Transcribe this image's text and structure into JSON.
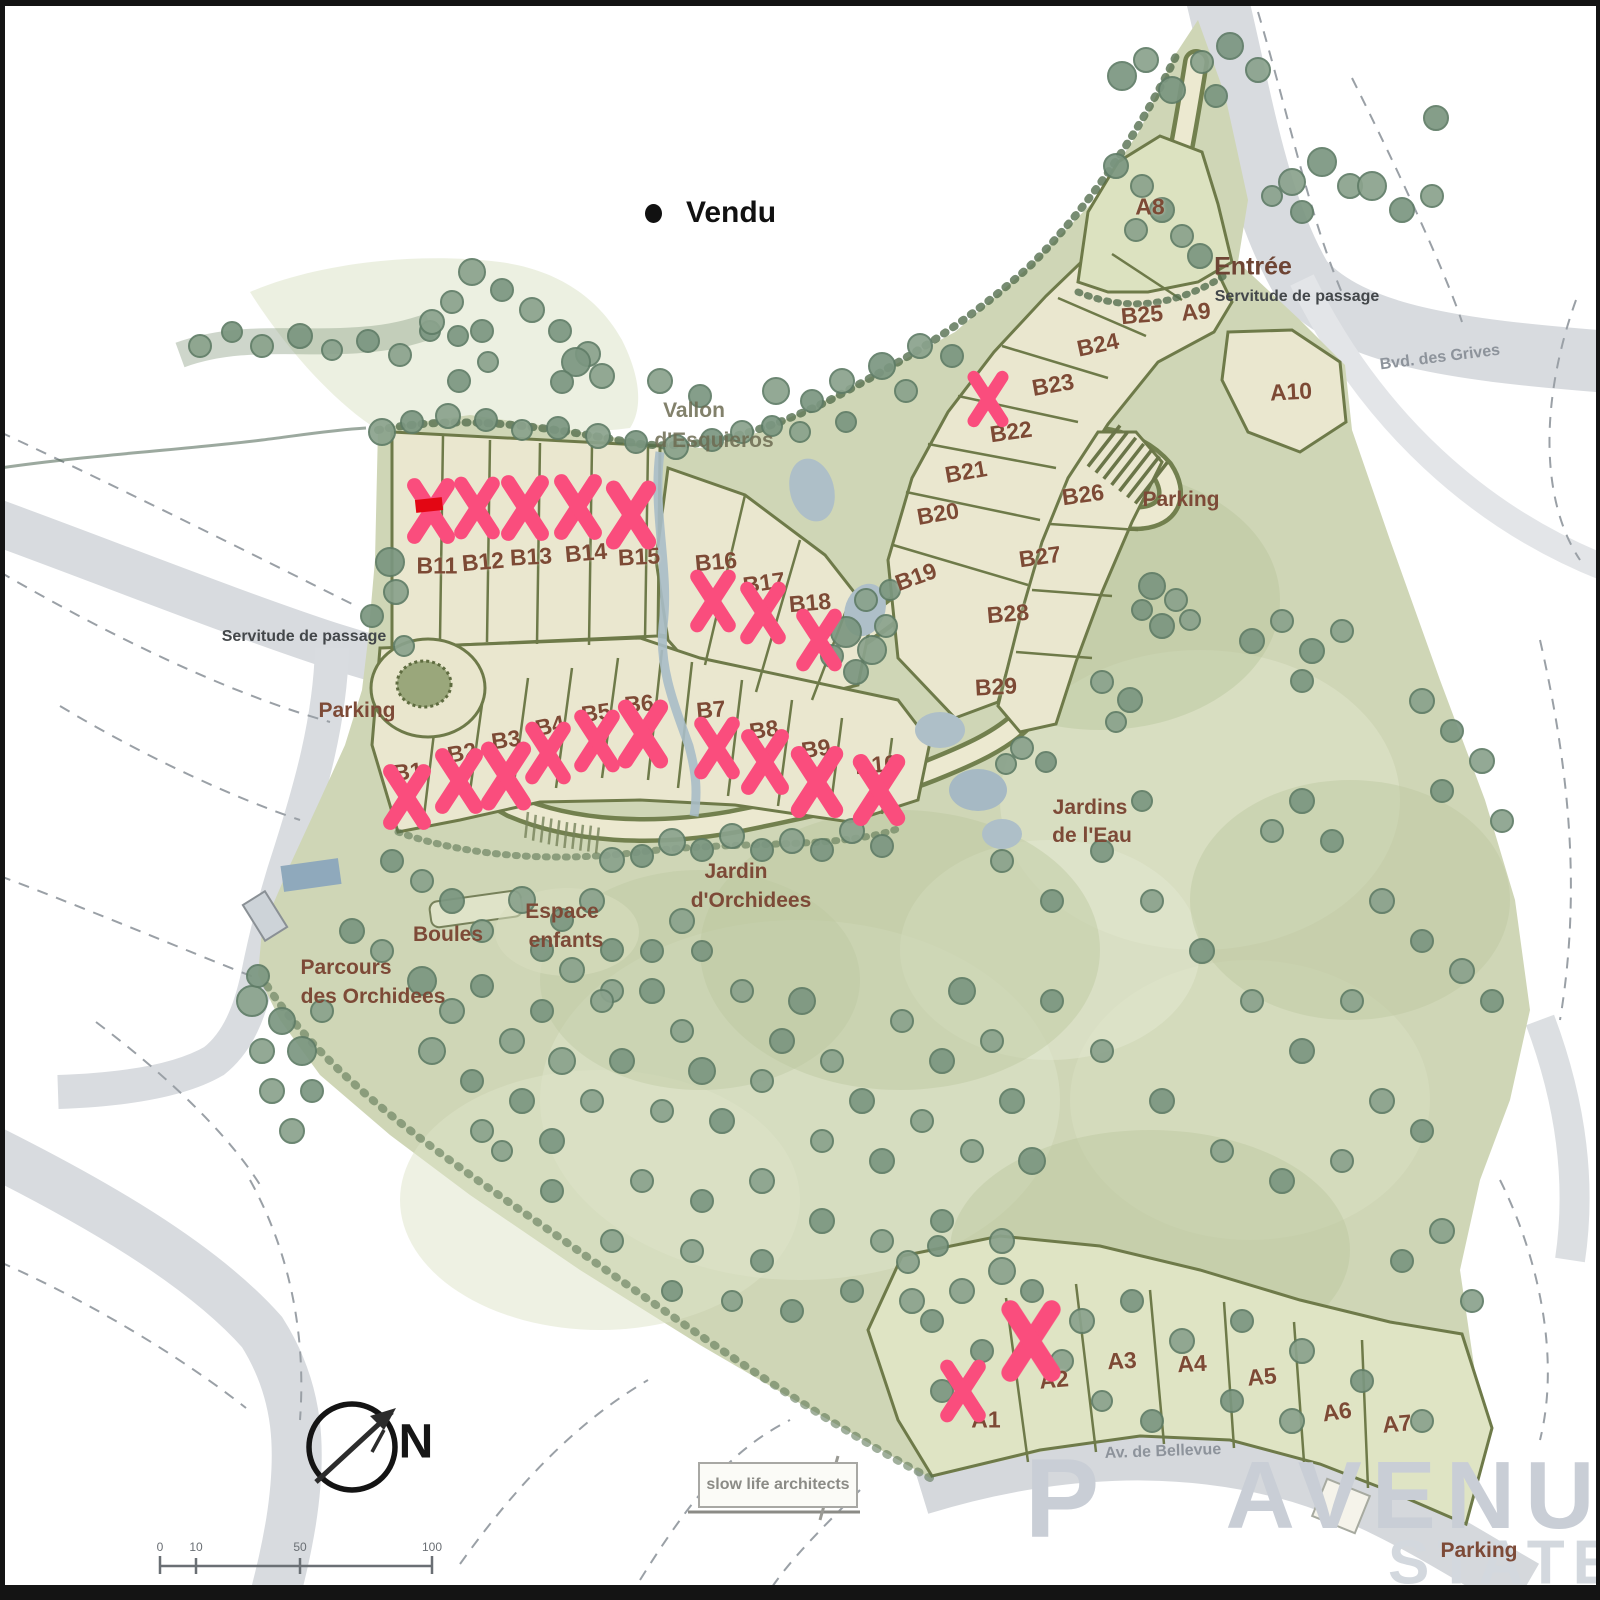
{
  "legend": {
    "label": "Vendu"
  },
  "compass": {
    "label": "N"
  },
  "attribution": {
    "label": "slow life architects"
  },
  "watermark": {
    "fragment": "P",
    "line1": "AVENUE",
    "line2": "STATE"
  },
  "scalebar": {
    "ticks": [
      "0",
      "10",
      "50",
      "100"
    ]
  },
  "colors": {
    "sold_mark": "#fa4d7d",
    "lot_label_brown": "#7d4a35",
    "site_green": "#cfd6b6",
    "lot_fill": "#eae7cf",
    "road_gray": "#d8dbdf",
    "tree_green": "#84a087",
    "red_rect": "#e30613"
  },
  "lots": [
    {
      "id": "B1",
      "x": 408,
      "y": 772,
      "rot": -6,
      "sold": true,
      "mark": {
        "x": 407,
        "y": 797,
        "s": 1.05
      }
    },
    {
      "id": "B2",
      "x": 462,
      "y": 753,
      "rot": -10,
      "sold": true,
      "mark": {
        "x": 459,
        "y": 781,
        "s": 1.05
      }
    },
    {
      "id": "B3",
      "x": 506,
      "y": 740,
      "rot": -8,
      "sold": true,
      "mark": {
        "x": 506,
        "y": 776,
        "s": 1.1
      }
    },
    {
      "id": "B4",
      "x": 550,
      "y": 726,
      "rot": -12,
      "sold": true,
      "mark": {
        "x": 548,
        "y": 753,
        "s": 1
      }
    },
    {
      "id": "B5",
      "x": 596,
      "y": 713,
      "rot": -8,
      "sold": true,
      "mark": {
        "x": 597,
        "y": 741,
        "s": 1
      }
    },
    {
      "id": "B6",
      "x": 639,
      "y": 704,
      "rot": -5,
      "sold": true,
      "mark": {
        "x": 643,
        "y": 734,
        "s": 1.1
      }
    },
    {
      "id": "B7",
      "x": 711,
      "y": 710,
      "rot": -5,
      "sold": true,
      "mark": {
        "x": 717,
        "y": 748,
        "s": 1
      }
    },
    {
      "id": "B8",
      "x": 764,
      "y": 730,
      "rot": -8,
      "sold": true,
      "mark": {
        "x": 765,
        "y": 762,
        "s": 1.05
      }
    },
    {
      "id": "B9",
      "x": 816,
      "y": 749,
      "rot": -8,
      "sold": true,
      "mark": {
        "x": 817,
        "y": 782,
        "s": 1.15
      }
    },
    {
      "id": "B10",
      "x": 876,
      "y": 765,
      "rot": -5,
      "sold": true,
      "mark": {
        "x": 879,
        "y": 790,
        "s": 1.15
      }
    },
    {
      "id": "B11",
      "x": 437,
      "y": 566,
      "rot": 0,
      "sold": true,
      "mark": {
        "x": 431,
        "y": 511,
        "s": 1.05
      }
    },
    {
      "id": "B12",
      "x": 483,
      "y": 562,
      "rot": -5,
      "sold": true,
      "mark": {
        "x": 477,
        "y": 508,
        "s": 1
      }
    },
    {
      "id": "B13",
      "x": 531,
      "y": 557,
      "rot": -3,
      "sold": true,
      "mark": {
        "x": 525,
        "y": 508,
        "s": 1.05
      }
    },
    {
      "id": "B14",
      "x": 586,
      "y": 553,
      "rot": -5,
      "sold": true,
      "mark": {
        "x": 578,
        "y": 507,
        "s": 1.05
      }
    },
    {
      "id": "B15",
      "x": 639,
      "y": 557,
      "rot": -3,
      "sold": true,
      "mark": {
        "x": 631,
        "y": 515,
        "s": 1.1
      }
    },
    {
      "id": "B16",
      "x": 716,
      "y": 562,
      "rot": -5,
      "sold": true,
      "mark": {
        "x": 713,
        "y": 601,
        "s": 1
      }
    },
    {
      "id": "B17",
      "x": 764,
      "y": 583,
      "rot": -8,
      "sold": true,
      "mark": {
        "x": 763,
        "y": 613,
        "s": 1
      }
    },
    {
      "id": "B18",
      "x": 810,
      "y": 603,
      "rot": -5,
      "sold": true,
      "mark": {
        "x": 819,
        "y": 640,
        "s": 1
      }
    },
    {
      "id": "B19",
      "x": 916,
      "y": 577,
      "rot": -20,
      "sold": false
    },
    {
      "id": "B20",
      "x": 938,
      "y": 514,
      "rot": -10,
      "sold": false
    },
    {
      "id": "B21",
      "x": 966,
      "y": 472,
      "rot": -10,
      "sold": false
    },
    {
      "id": "B22",
      "x": 1011,
      "y": 432,
      "rot": -8,
      "sold": true,
      "mark": {
        "x": 988,
        "y": 399,
        "s": 0.9
      }
    },
    {
      "id": "B23",
      "x": 1053,
      "y": 385,
      "rot": -10,
      "sold": false
    },
    {
      "id": "B24",
      "x": 1098,
      "y": 345,
      "rot": -12,
      "sold": false
    },
    {
      "id": "B25",
      "x": 1142,
      "y": 315,
      "rot": -5,
      "sold": false
    },
    {
      "id": "B26",
      "x": 1083,
      "y": 495,
      "rot": -8,
      "sold": false
    },
    {
      "id": "B27",
      "x": 1040,
      "y": 557,
      "rot": -8,
      "sold": false
    },
    {
      "id": "B28",
      "x": 1008,
      "y": 614,
      "rot": -5,
      "sold": false
    },
    {
      "id": "B29",
      "x": 996,
      "y": 687,
      "rot": -3,
      "sold": false
    },
    {
      "id": "A1",
      "x": 986,
      "y": 1420,
      "rot": 0,
      "sold": true,
      "mark": {
        "x": 963,
        "y": 1391,
        "s": 1
      }
    },
    {
      "id": "A2",
      "x": 1054,
      "y": 1380,
      "rot": -5,
      "sold": true,
      "mark": {
        "x": 1031,
        "y": 1341,
        "s": 1.3
      }
    },
    {
      "id": "A3",
      "x": 1122,
      "y": 1361,
      "rot": -3,
      "sold": false
    },
    {
      "id": "A4",
      "x": 1192,
      "y": 1364,
      "rot": -3,
      "sold": false
    },
    {
      "id": "A5",
      "x": 1262,
      "y": 1377,
      "rot": -5,
      "sold": false
    },
    {
      "id": "A6",
      "x": 1337,
      "y": 1412,
      "rot": -8,
      "sold": false
    },
    {
      "id": "A7",
      "x": 1397,
      "y": 1424,
      "rot": -5,
      "sold": false
    },
    {
      "id": "A8",
      "x": 1150,
      "y": 207,
      "rot": 0,
      "sold": false
    },
    {
      "id": "A9",
      "x": 1196,
      "y": 312,
      "rot": -5,
      "sold": false
    },
    {
      "id": "A10",
      "x": 1291,
      "y": 392,
      "rot": -3,
      "sold": false
    }
  ],
  "places": [
    {
      "id": "entree",
      "text": "Entrée",
      "x": 1253,
      "y": 267,
      "cls": "brown-lg",
      "rot": 0
    },
    {
      "id": "entree-note",
      "text": "Servitude de passage",
      "x": 1297,
      "y": 297,
      "cls": "dark",
      "rot": 0
    },
    {
      "id": "bvd-grives",
      "text": "Bvd. des Grives",
      "x": 1440,
      "y": 358,
      "cls": "gray",
      "rot": -7
    },
    {
      "id": "servitude-west",
      "text": "Servitude de passage",
      "x": 304,
      "y": 637,
      "cls": "dark",
      "rot": 0
    },
    {
      "id": "parking-west",
      "text": "Parking",
      "x": 357,
      "y": 711,
      "cls": "brown",
      "rot": 0
    },
    {
      "id": "parking-north",
      "text": "Parking",
      "x": 1181,
      "y": 500,
      "cls": "brown",
      "rot": 0
    },
    {
      "id": "parking-south",
      "text": "Parking",
      "x": 1479,
      "y": 1551,
      "cls": "brown",
      "rot": 0
    },
    {
      "id": "vallon-1",
      "text": "Vallon",
      "x": 694,
      "y": 411,
      "cls": "olive",
      "rot": 0
    },
    {
      "id": "vallon-2",
      "text": "d'Esquieros",
      "x": 714,
      "y": 441,
      "cls": "olive",
      "rot": 0
    },
    {
      "id": "jardins-eau-1",
      "text": "Jardins",
      "x": 1090,
      "y": 808,
      "cls": "brown",
      "rot": 0
    },
    {
      "id": "jardins-eau-2",
      "text": "de l'Eau",
      "x": 1092,
      "y": 836,
      "cls": "brown",
      "rot": 0
    },
    {
      "id": "jardin-orch-1",
      "text": "Jardin",
      "x": 736,
      "y": 872,
      "cls": "brown",
      "rot": 0
    },
    {
      "id": "jardin-orch-2",
      "text": "d'Orchidees",
      "x": 751,
      "y": 901,
      "cls": "brown",
      "rot": 0
    },
    {
      "id": "espace-1",
      "text": "Espace",
      "x": 562,
      "y": 912,
      "cls": "brown",
      "rot": 0
    },
    {
      "id": "espace-2",
      "text": "enfants",
      "x": 566,
      "y": 941,
      "cls": "brown",
      "rot": 0
    },
    {
      "id": "boules",
      "text": "Boules",
      "x": 448,
      "y": 935,
      "cls": "brown",
      "rot": 0
    },
    {
      "id": "parcours-1",
      "text": "Parcours",
      "x": 346,
      "y": 968,
      "cls": "brown",
      "rot": 0
    },
    {
      "id": "parcours-2",
      "text": "des Orchidees",
      "x": 373,
      "y": 997,
      "cls": "brown",
      "rot": 0
    },
    {
      "id": "av-bellevue",
      "text": "Av. de Bellevue",
      "x": 1163,
      "y": 1452,
      "cls": "gray",
      "rot": -2
    }
  ]
}
